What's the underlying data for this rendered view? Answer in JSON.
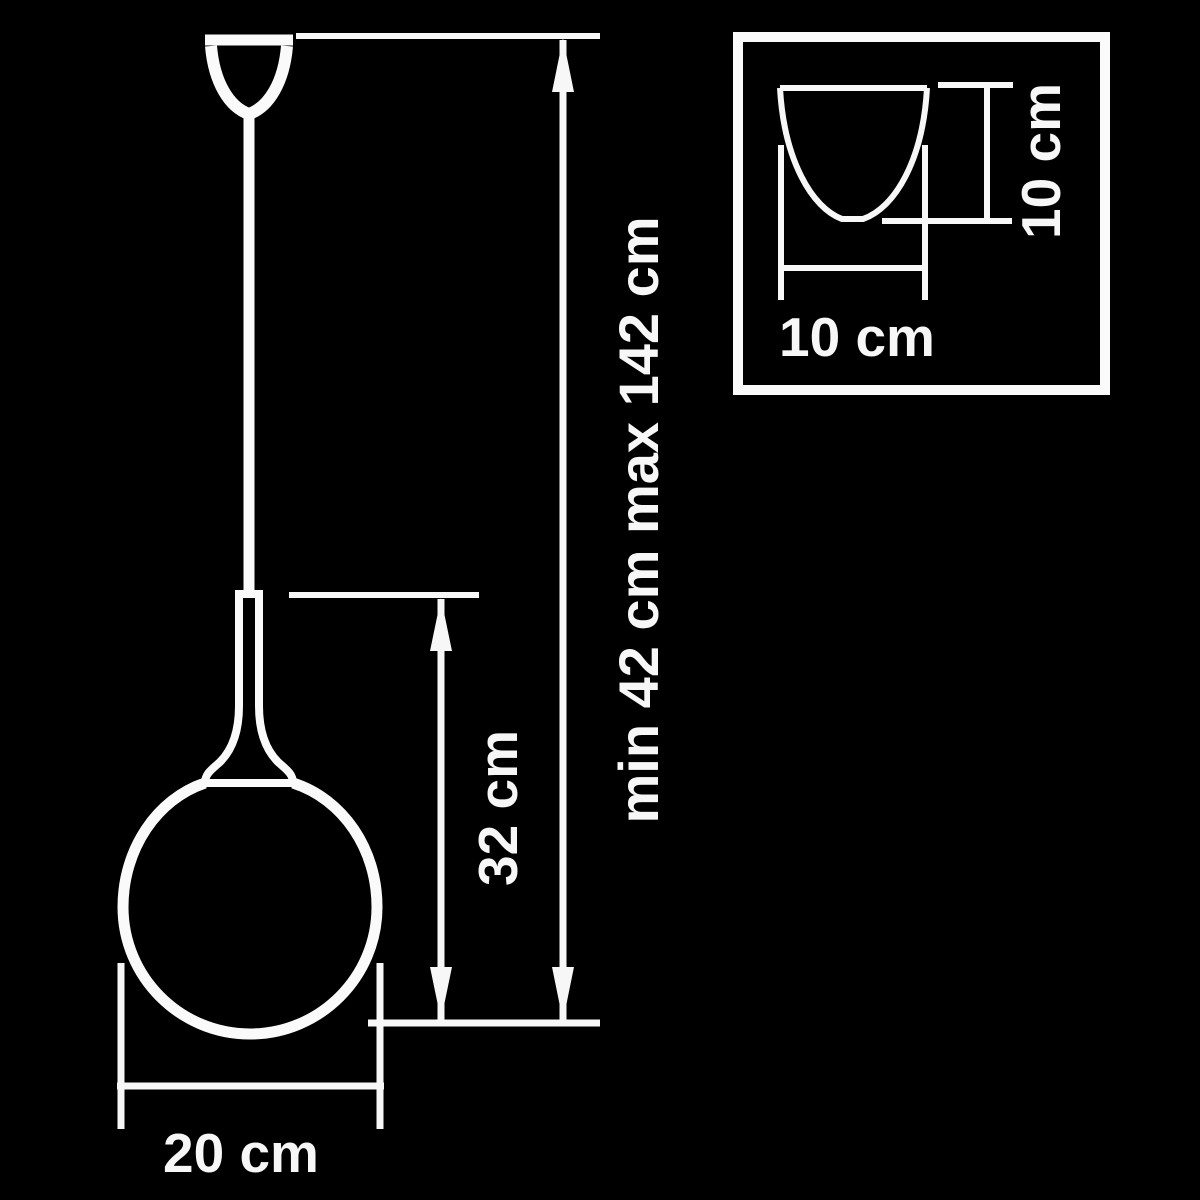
{
  "diagram": {
    "title": "pendant-lamp-dimension-drawing",
    "colors": {
      "background": "#000000",
      "line": "#ffffff"
    },
    "labels": {
      "overall_height": "min 42 cm max 142 cm",
      "body_height": "32 cm",
      "globe_diameter": "20 cm",
      "inset_width": "10 cm",
      "inset_height": "10 cm"
    }
  }
}
